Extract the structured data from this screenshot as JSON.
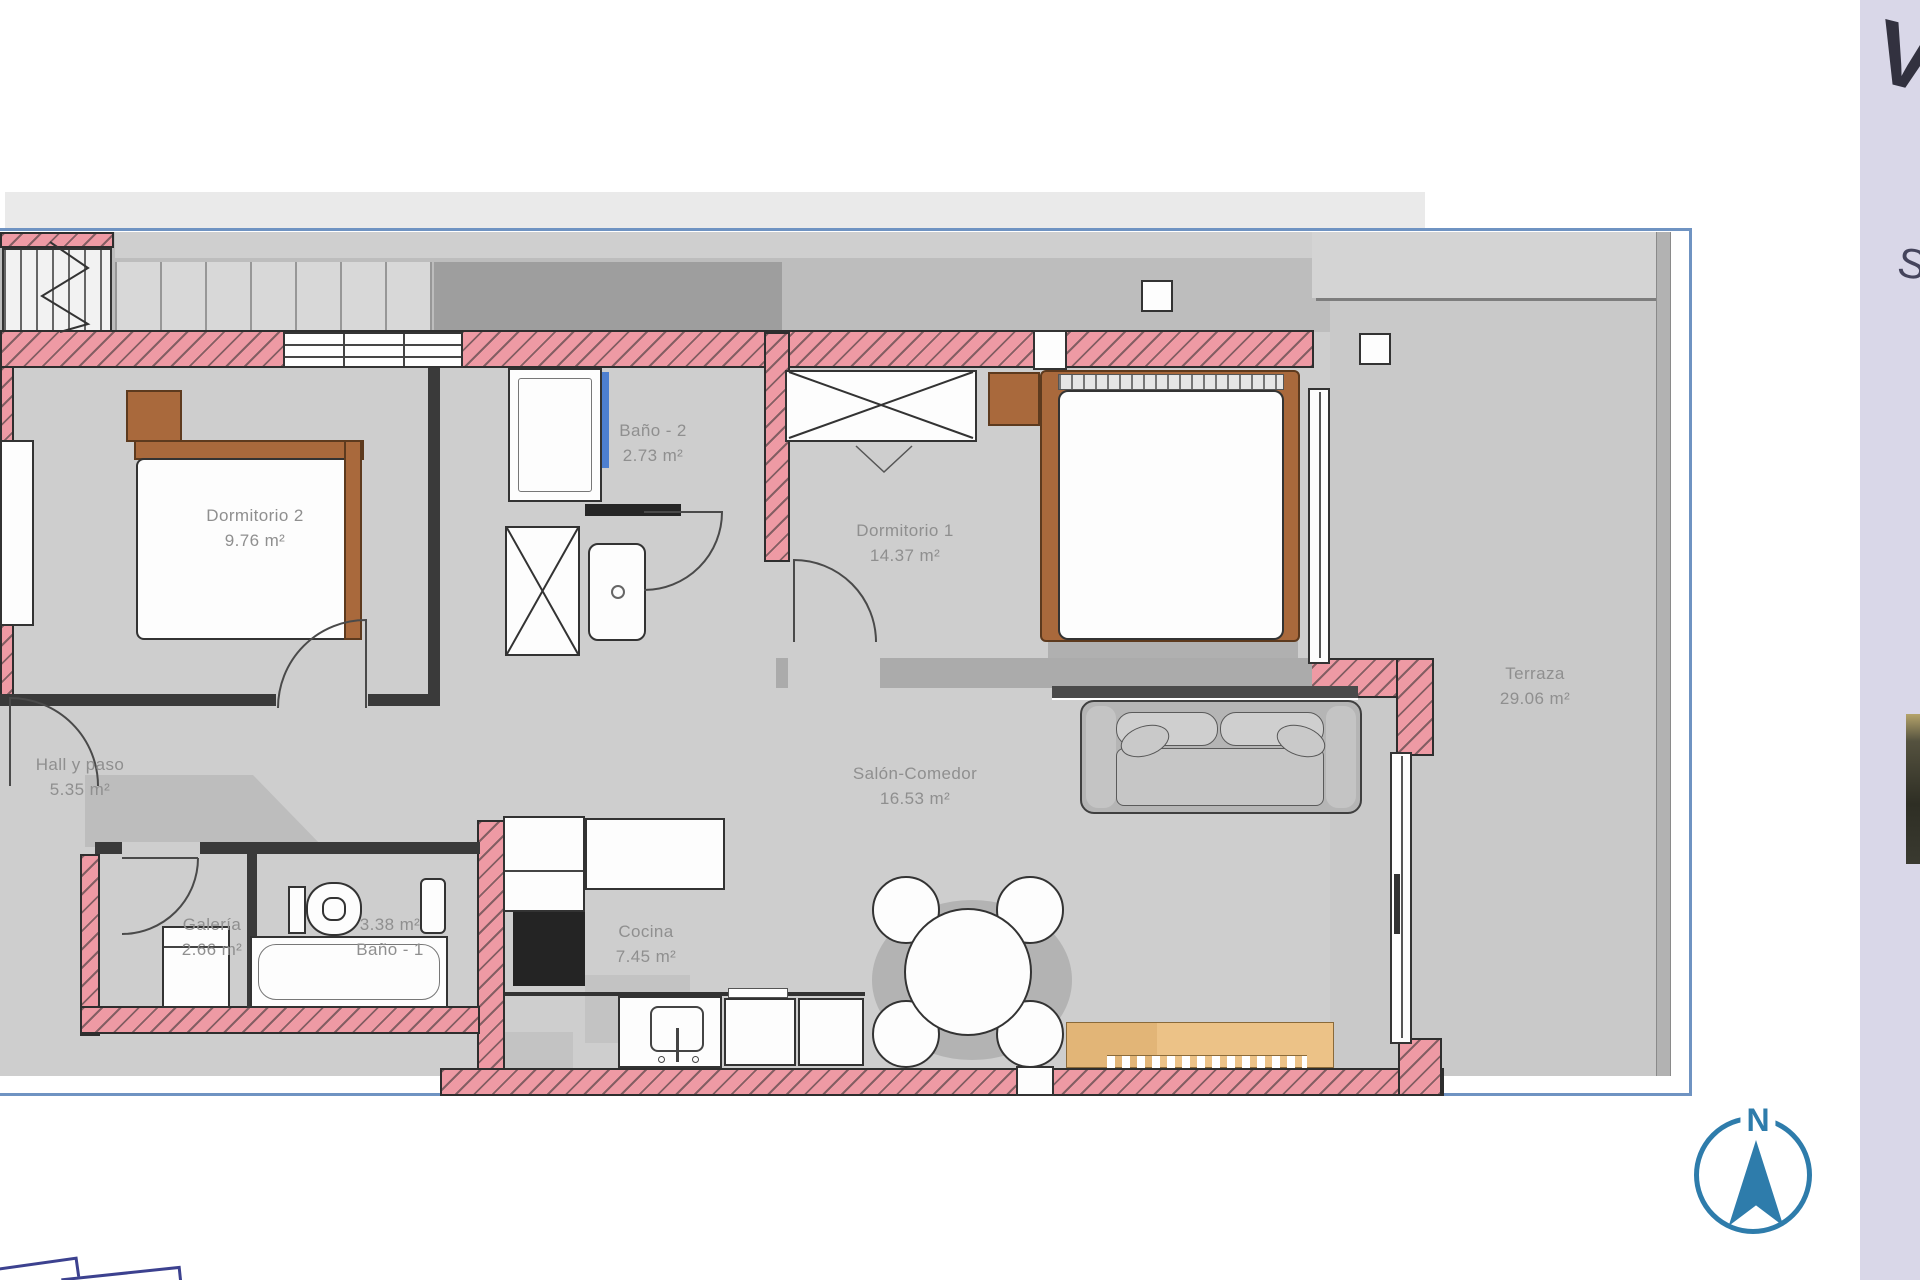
{
  "plan": {
    "rooms": [
      {
        "name": "Dormitorio 2",
        "area": "9.76 m²"
      },
      {
        "name": "Baño - 2",
        "area": "2.73 m²"
      },
      {
        "name": "Dormitorio 1",
        "area": "14.37 m²"
      },
      {
        "name": "Terraza",
        "area": "29.06 m²"
      },
      {
        "name": "Hall y paso",
        "area": "5.35 m²"
      },
      {
        "name": "Galería",
        "area": "2.66 m²"
      },
      {
        "name": "Baño - 1",
        "area": "3.38 m²"
      },
      {
        "name": "Cocina",
        "area": "7.45 m²"
      },
      {
        "name": "Salón-Comedor",
        "area": "16.53 m²"
      }
    ]
  },
  "compass": {
    "north_label": "N"
  },
  "sidebar": {
    "letter_top": "V",
    "letter_mid": "S"
  },
  "colors": {
    "wall_pink": "#ee9aa4",
    "frame_blue": "#6f93c2",
    "compass_blue": "#2e7cab",
    "sidebar_lavender": "#d9d7e8",
    "wood_brown": "#a9693c",
    "sideboard_tan": "#ecc287",
    "floor_gray": "#cecece",
    "terrace_gray": "#c9c9c9",
    "shower_glass_blue": "#4d7fd0"
  }
}
